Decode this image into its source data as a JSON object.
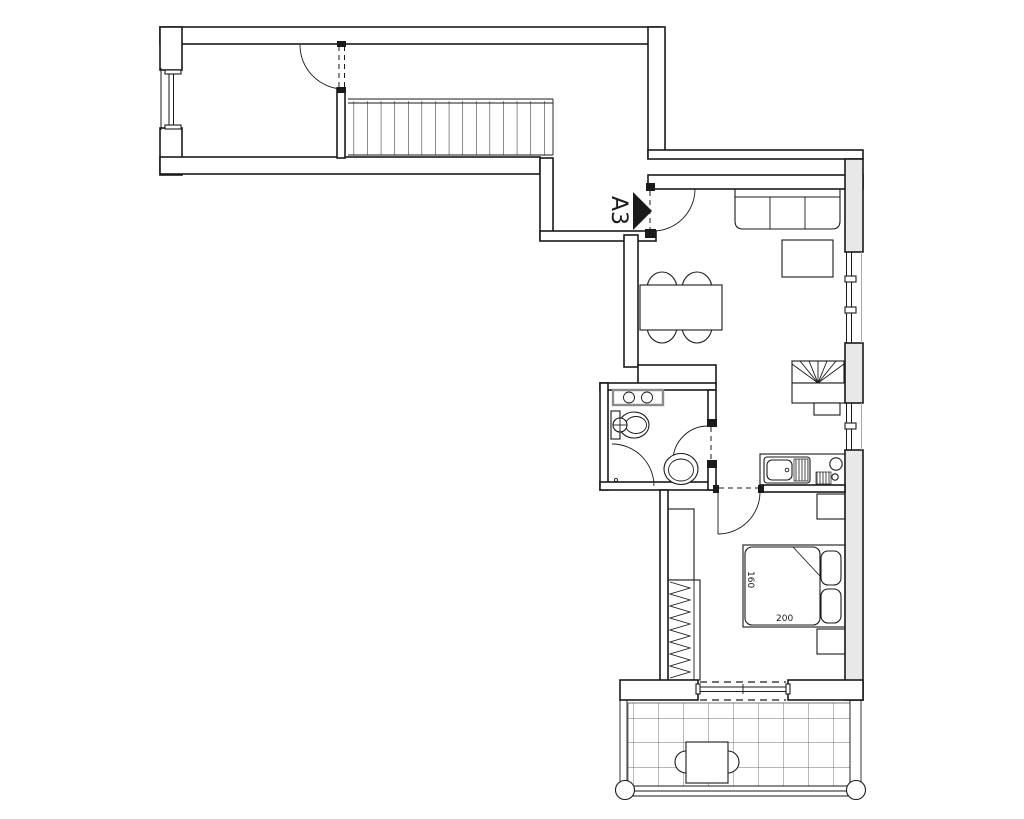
{
  "drawing": {
    "unit_label": "A3",
    "bed_width_label": "160",
    "bed_length_label": "200"
  },
  "colors": {
    "line": "#1a1a1a",
    "background": "#ffffff",
    "wall_fill": "#ffffff",
    "exterior_wall_fill": "#e8e8e8",
    "vanity_stroke": "#8c8c8c"
  },
  "fixtures": [
    "staircase",
    "entrance-door",
    "sofa",
    "coffee-table",
    "dining-table",
    "dining-chairs",
    "fireplace",
    "kitchenette-sink",
    "kitchenette-cooktop",
    "bathroom-vanity",
    "toilet",
    "shower",
    "wc-bowl",
    "wardrobe",
    "double-bed",
    "nightstand",
    "balcony-table",
    "balcony-chair",
    "balcony-railing",
    "balcony-tiles",
    "window",
    "door-swing"
  ]
}
